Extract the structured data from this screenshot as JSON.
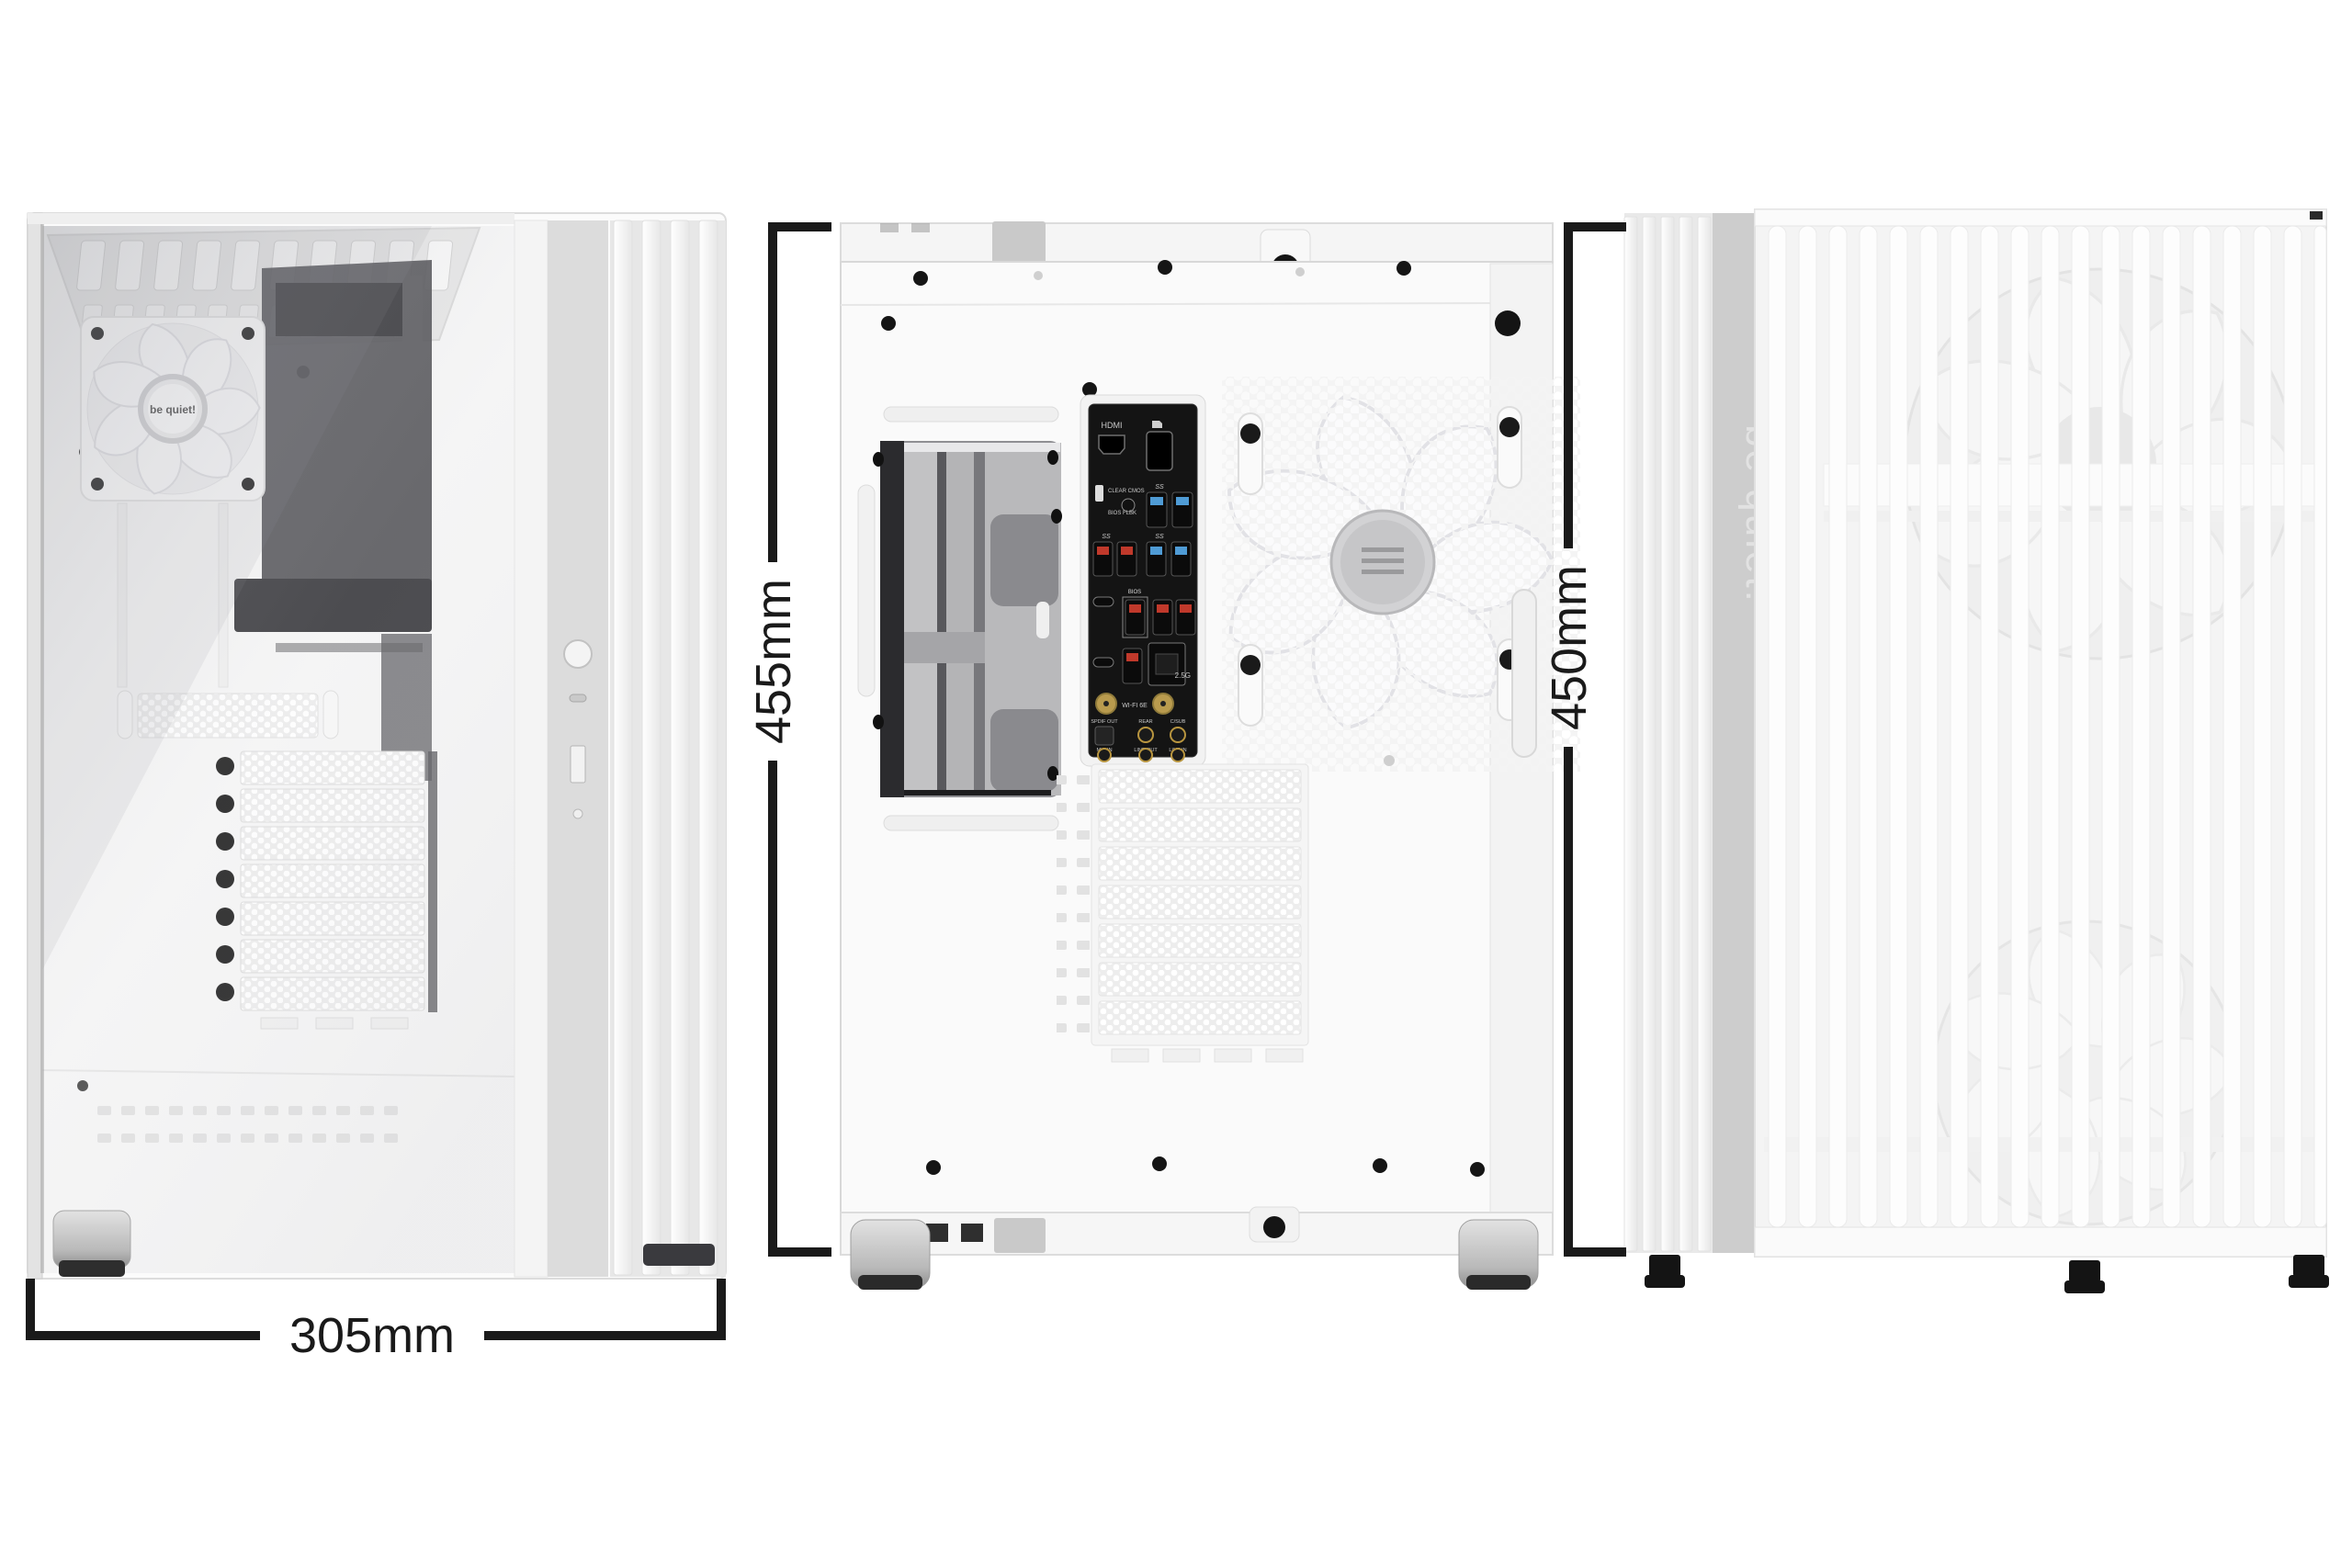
{
  "dimensions": {
    "front_width": "305mm",
    "side_height": "455mm",
    "front_height": "450mm"
  },
  "brand": {
    "fan_hub_logo": "be quiet!",
    "front_panel_logo": "be quiet!"
  },
  "io_panel": {
    "hdmi": "HDMI",
    "clear_cmos": "CLEAR CMOS",
    "bios_flashback": "BIOS FLBK",
    "bios_port": "BIOS",
    "usb_speed": "SS",
    "lan": "2.5G",
    "wifi": "WI-FI 6E",
    "audio": [
      "SPDIF OUT",
      "REAR",
      "C/SUB",
      "MIC IN",
      "LINE OUT",
      "LINE IN"
    ]
  },
  "colors": {
    "dimension_line": "#1a1a1a",
    "case_white": "#f7f7f7",
    "accent_gray": "#cdcdcd",
    "usb3_blue": "#4f9bd5",
    "usb_red": "#c0392b",
    "wifi_gold": "#b99b4e"
  }
}
